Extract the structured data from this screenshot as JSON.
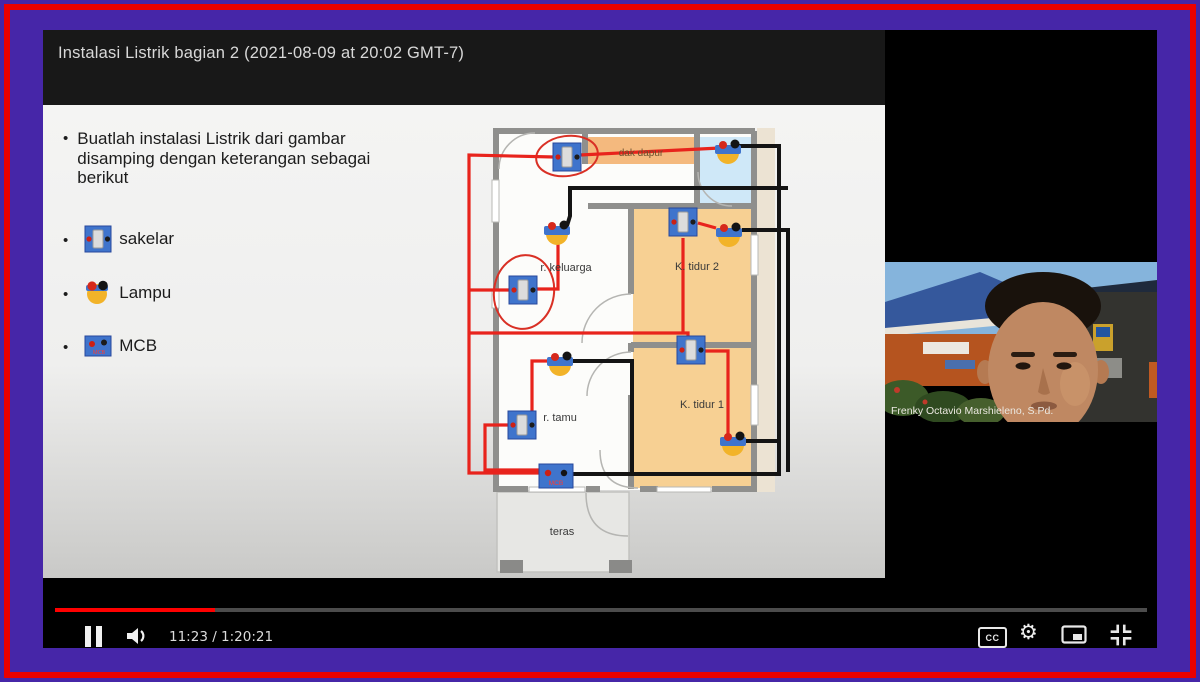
{
  "frame": {
    "outer_color": "#4626a8",
    "ring_color": "#ec0000"
  },
  "titlebar": {
    "title": "Instalasi Listrik bagian 2 (2021-08-09 at 20:02 GMT-7)"
  },
  "slide": {
    "instruction": "Buatlah instalasi Listrik dari gambar disamping dengan keterangan sebagai berikut",
    "legend_items": [
      {
        "id": "sakelar",
        "label": "sakelar"
      },
      {
        "id": "lampu",
        "label": "Lampu"
      },
      {
        "id": "mcb",
        "label": "MCB"
      }
    ],
    "floorplan": {
      "labels": {
        "dak_dapur": "dak dapur",
        "k_tidur_2": "K. tidur 2",
        "r_keluarga": "r. keluarga",
        "k_tidur_1": "K. tidur 1",
        "r_tamu": "r. tamu",
        "teras": "teras",
        "mcb": "MCB"
      },
      "wire_colors": {
        "live": "#e8231c",
        "neutral": "#141414"
      }
    }
  },
  "webcam": {
    "caption": "Frenky Octavio Marshieleno, S.Pd."
  },
  "player": {
    "time_display": "11:23 / 1:20:21",
    "progress_percent": 14.6,
    "captions_label": "CC",
    "controls": [
      "pause",
      "volume",
      "captions",
      "settings",
      "miniplayer",
      "exit-fullscreen"
    ]
  }
}
